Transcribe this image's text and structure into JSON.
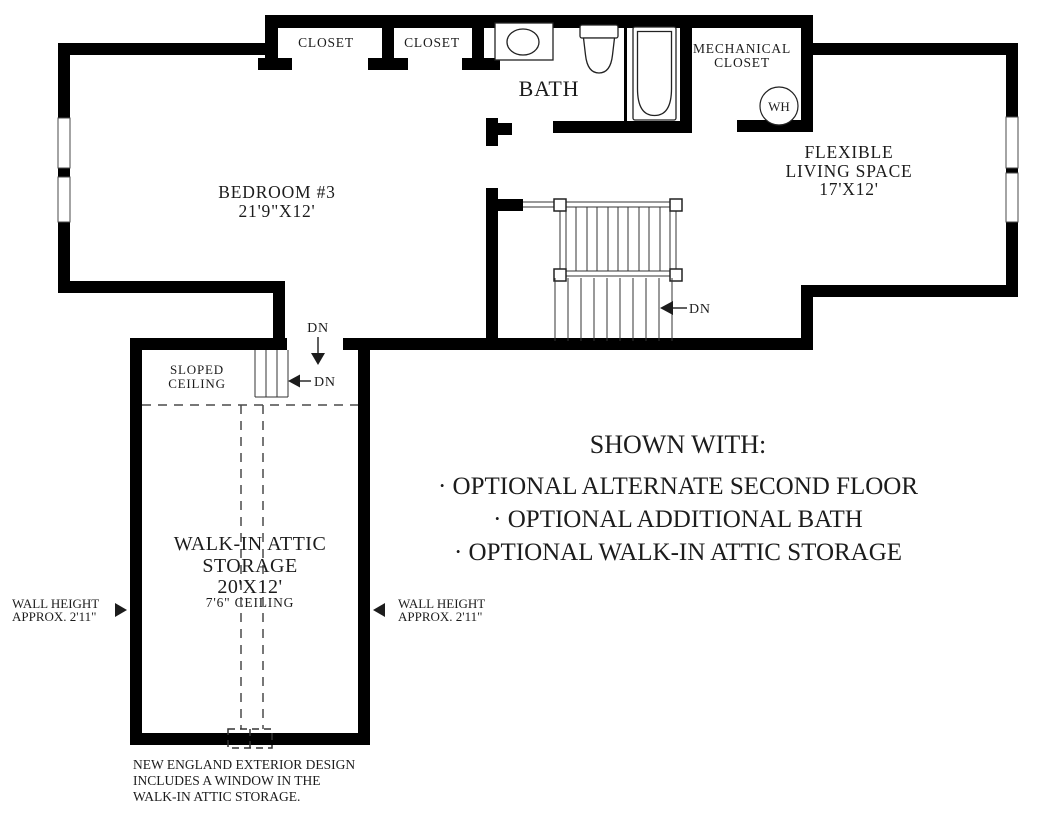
{
  "rooms": {
    "closet_left": {
      "label": "CLOSET"
    },
    "closet_right": {
      "label": "CLOSET"
    },
    "bath": {
      "label": "BATH"
    },
    "mechanical_closet": {
      "line1": "MECHANICAL",
      "line2": "CLOSET"
    },
    "water_heater": {
      "label": "WH"
    },
    "flexible_living_space": {
      "line1": "FLEXIBLE",
      "line2": "LIVING SPACE",
      "dimensions": "17'X12'"
    },
    "bedroom_3": {
      "line1": "BEDROOM #3",
      "dimensions": "21'9\"X12'"
    },
    "walk_in_attic_storage": {
      "line1": "WALK-IN ATTIC",
      "line2": "STORAGE",
      "dimensions": "20'X12'",
      "ceiling": "7'6\" CEILING"
    },
    "sloped_ceiling": {
      "line1": "SLOPED",
      "line2": "CEILING"
    }
  },
  "stair_labels": {
    "main_stairs_down": "DN",
    "attic_entry_down": "DN",
    "attic_steps_down": "DN"
  },
  "annotations": {
    "wall_height_left": {
      "line1": "WALL HEIGHT",
      "line2": "APPROX. 2'11\""
    },
    "wall_height_right": {
      "line1": "WALL HEIGHT",
      "line2": "APPROX. 2'11\""
    },
    "shown_with": {
      "title": "SHOWN WITH:",
      "items": [
        "· OPTIONAL ALTERNATE SECOND FLOOR",
        "· OPTIONAL ADDITIONAL BATH",
        "· OPTIONAL WALK-IN ATTIC STORAGE"
      ]
    },
    "exterior_note": {
      "line1": "NEW ENGLAND EXTERIOR DESIGN",
      "line2": "INCLUDES A WINDOW IN THE",
      "line3": "WALK-IN ATTIC STORAGE."
    }
  },
  "colors": {
    "walls": "#000000",
    "text": "#1c1c1c",
    "background": "#ffffff"
  }
}
